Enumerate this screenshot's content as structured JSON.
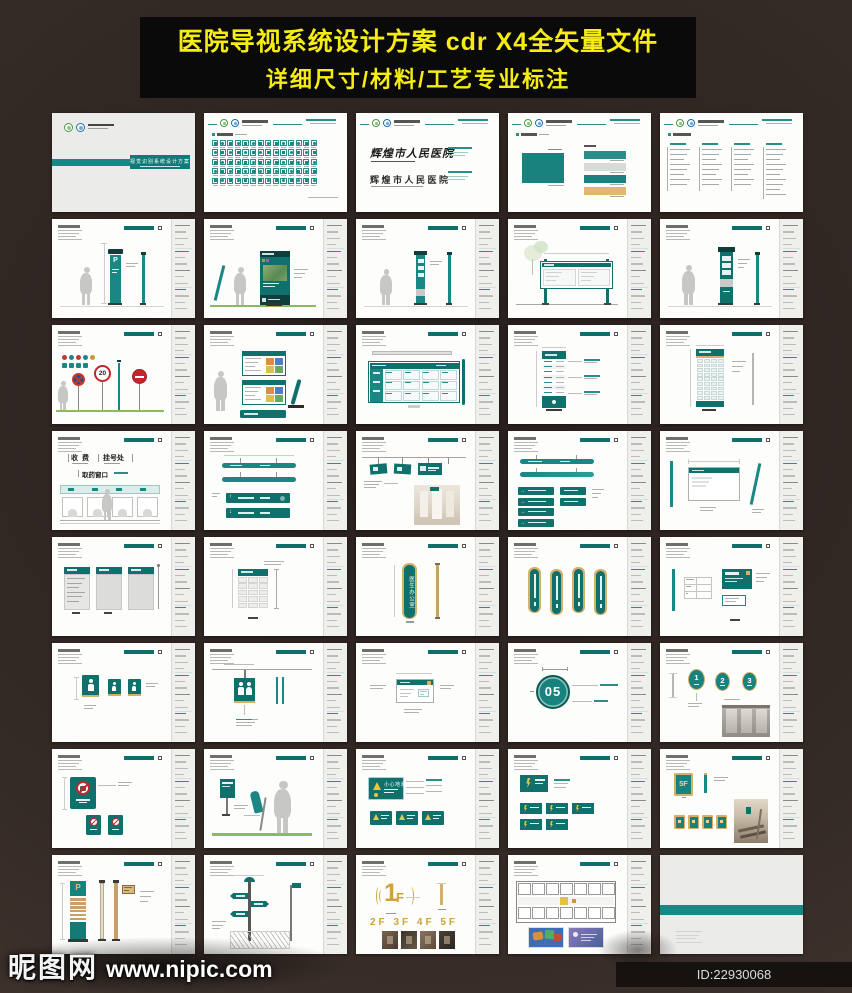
{
  "banner": {
    "line1": "医院导视系统设计方案 cdr X4全矢量文件",
    "line2": "详细尺寸/材料/工艺专业标注"
  },
  "watermark": {
    "site_name": "昵图网",
    "site_url": "www.nipic.com"
  },
  "footer_id": {
    "text": "ID:22930068 NO:20210121150921459514"
  },
  "hospital": {
    "name_cn": "辉煌市人民医院",
    "system_label": "视觉识别系统设计方案"
  },
  "colors": {
    "teal": "#1a8784",
    "teal_dark": "#10706c",
    "teal_deep": "#0e3f3c",
    "gold": "#d4b06a",
    "banner_yellow": "#f6ec13",
    "background": "#372b26",
    "red": "#c4262d",
    "grass": "#8abb5e",
    "page": "#fdfdfc",
    "cover_gray": "#ebebe9",
    "gold_text": "#cfa23c"
  },
  "grid": {
    "columns": 5,
    "rows": 8,
    "pages": [
      {
        "kind": "cover",
        "band_label": "视觉识别系统设计方案"
      },
      {
        "kind": "icons"
      },
      {
        "kind": "logotype",
        "name_script": "辉煌市人民医院",
        "name_std": "辉煌市人民医院"
      },
      {
        "kind": "colorsPage"
      },
      {
        "kind": "lists"
      },
      {
        "kind": "parkSign",
        "label": "P"
      },
      {
        "kind": "photoSign"
      },
      {
        "kind": "slimSign"
      },
      {
        "kind": "noticeBoard"
      },
      {
        "kind": "tallSign"
      },
      {
        "kind": "traffic",
        "speed": "20"
      },
      {
        "kind": "dirPanels"
      },
      {
        "kind": "gridBoard"
      },
      {
        "kind": "tallDir"
      },
      {
        "kind": "denseDir"
      },
      {
        "kind": "counters",
        "label1": "收 费",
        "label2": "挂号处",
        "label3": "取药窗口"
      },
      {
        "kind": "hangBars",
        "arrow_up": "↑",
        "arrow_down": "↓"
      },
      {
        "kind": "ceilSigns"
      },
      {
        "kind": "stripSigns",
        "arrow": "→"
      },
      {
        "kind": "doorPlate"
      },
      {
        "kind": "posterFrames"
      },
      {
        "kind": "gridPanel"
      },
      {
        "kind": "curvedPlate",
        "label": "医生办公室"
      },
      {
        "kind": "curvedPlates"
      },
      {
        "kind": "smallPlate"
      },
      {
        "kind": "toiletSigns"
      },
      {
        "kind": "toiletDim"
      },
      {
        "kind": "smallSign"
      },
      {
        "kind": "floorCircle",
        "label": "05"
      },
      {
        "kind": "numOvals",
        "n1": "1",
        "n2": "2",
        "n3": "3"
      },
      {
        "kind": "prohibit"
      },
      {
        "kind": "lawnSign"
      },
      {
        "kind": "warnSigns",
        "label": "小心地滑"
      },
      {
        "kind": "powerSigns"
      },
      {
        "kind": "floorPlate",
        "label": "5F"
      },
      {
        "kind": "parkPole",
        "label": "P"
      },
      {
        "kind": "fingerpost"
      },
      {
        "kind": "floorNums",
        "big_digit": "1",
        "big_suffix": "F",
        "row": "2F 3F 4F 5F"
      },
      {
        "kind": "floorplan"
      },
      {
        "kind": "backcover"
      }
    ]
  }
}
